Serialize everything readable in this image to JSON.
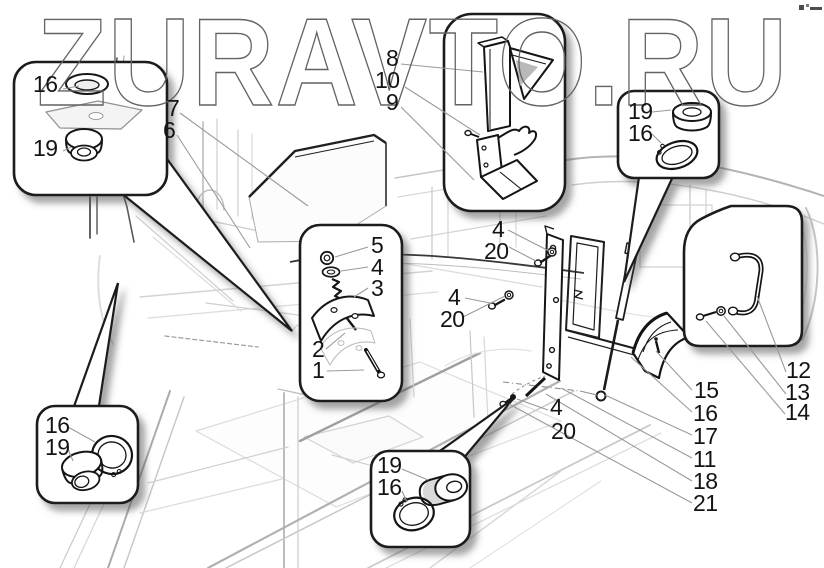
{
  "watermark": {
    "text": "ZURAVTO.RU"
  },
  "part_labels": [
    {
      "id": "top-left-16",
      "text": "16"
    },
    {
      "id": "top-left-19",
      "text": "19"
    },
    {
      "id": "panel-7",
      "text": "7"
    },
    {
      "id": "panel-6",
      "text": "6"
    },
    {
      "id": "bracket-8",
      "text": "8"
    },
    {
      "id": "bracket-10",
      "text": "10"
    },
    {
      "id": "bracket-9",
      "text": "9"
    },
    {
      "id": "top-right-19",
      "text": "19"
    },
    {
      "id": "top-right-16",
      "text": "16"
    },
    {
      "id": "spring-5",
      "text": "5"
    },
    {
      "id": "spring-4",
      "text": "4"
    },
    {
      "id": "spring-3",
      "text": "3"
    },
    {
      "id": "spring-2",
      "text": "2"
    },
    {
      "id": "spring-1",
      "text": "1"
    },
    {
      "id": "bolt-upper-4",
      "text": "4"
    },
    {
      "id": "bolt-upper-20",
      "text": "20"
    },
    {
      "id": "bolt-left-4",
      "text": "4"
    },
    {
      "id": "bolt-left-20",
      "text": "20"
    },
    {
      "id": "bolt-lower-4",
      "text": "4"
    },
    {
      "id": "bolt-lower-20",
      "text": "20"
    },
    {
      "id": "bottom-left-16",
      "text": "16"
    },
    {
      "id": "bottom-left-19",
      "text": "19"
    },
    {
      "id": "bottom-mid-19",
      "text": "19"
    },
    {
      "id": "bottom-mid-16",
      "text": "16"
    },
    {
      "id": "handle-12",
      "text": "12"
    },
    {
      "id": "handle-13",
      "text": "13"
    },
    {
      "id": "handle-14",
      "text": "14"
    },
    {
      "id": "right-15",
      "text": "15"
    },
    {
      "id": "right-16",
      "text": "16"
    },
    {
      "id": "right-17",
      "text": "17"
    },
    {
      "id": "right-11",
      "text": "11"
    },
    {
      "id": "right-18",
      "text": "18"
    },
    {
      "id": "right-21",
      "text": "21"
    }
  ]
}
